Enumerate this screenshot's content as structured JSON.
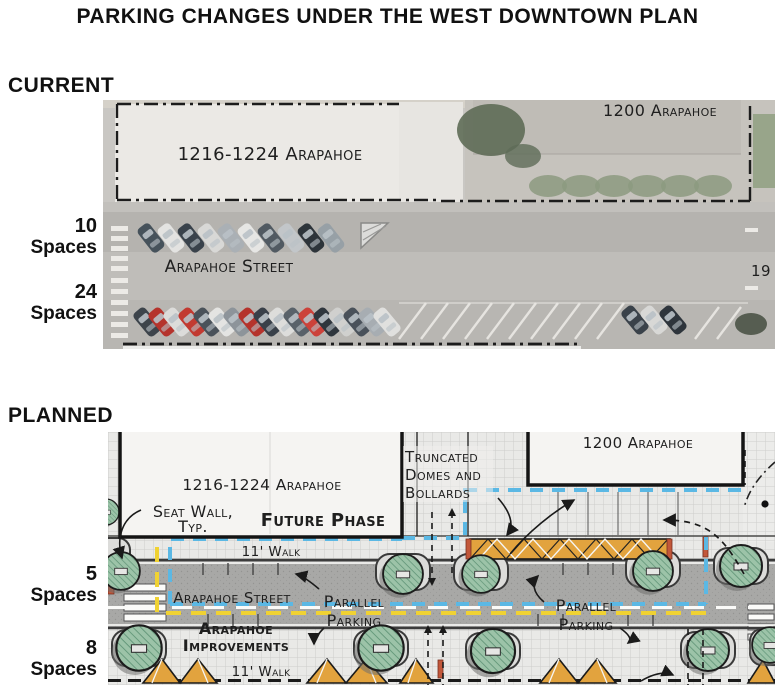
{
  "title": "PARKING CHANGES UNDER THE WEST DOWNTOWN PLAN",
  "current": {
    "heading": "CURRENT",
    "building_left_label": "1216-1224 Arapahoe",
    "building_right_label": "1200 Arapahoe",
    "street_label": "Arapahoe Street",
    "edge_label": "19",
    "spaces": [
      {
        "count": "10",
        "unit": "Spaces"
      },
      {
        "count": "24",
        "unit": "Spaces"
      }
    ]
  },
  "planned": {
    "heading": "PLANNED",
    "building_left_label": "1216-1224 Arapahoe",
    "building_right_label": "1200 Arapahoe",
    "seat_wall_line1": "Seat Wall,",
    "seat_wall_line2": "Typ.",
    "future_phase": "Future Phase",
    "truncated_line1": "Truncated",
    "truncated_line2": "Domes and",
    "truncated_line3": "Bollards",
    "walk_top": "11' Walk",
    "walk_bottom": "11' Walk",
    "street_label": "Arapahoe Street",
    "parallel_left_line1": "Parallel",
    "parallel_left_line2": "Parking",
    "parallel_right_line1": "Parallel",
    "parallel_right_line2": "Parking",
    "improvements_line1": "Arapahoe",
    "improvements_line2": "Improvements",
    "spaces": [
      {
        "count": "5",
        "unit": "Spaces"
      },
      {
        "count": "8",
        "unit": "Spaces"
      }
    ]
  },
  "colors": {
    "future_phase_text": "#3fa9dc",
    "improvements_text": "#e9cb2d",
    "blue_dash": "#5bb8e4",
    "yellow_dash": "#f0d232",
    "tree_green": "#9cc3a8",
    "planting_orange": "#e2a33e",
    "street_gray": "#a8a8a6"
  }
}
